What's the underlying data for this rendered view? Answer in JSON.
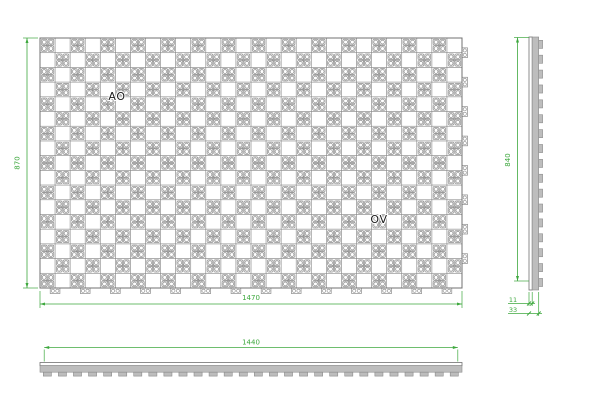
{
  "drawing": {
    "type": "cad-panel-drawing",
    "annotations": {
      "ao": "AO",
      "ov": "OV"
    },
    "dimensions": {
      "front_height": "870",
      "front_width": "1470",
      "side_height": "840",
      "plan_width": "1440",
      "thickness_inner": "11",
      "thickness_outer": "33"
    },
    "pattern": {
      "style": "checkerboard-perforated-modules",
      "columns": 28,
      "rows": 17,
      "right_tabs": 8,
      "bottom_tabs": 14,
      "side_teeth": 17,
      "bottom_teeth": 28
    },
    "colors": {
      "dimension_green": "#3EA83E",
      "line_gray": "#8C8C8C",
      "light_grid": "#C9C9C9",
      "outline": "#707070",
      "section_fill": "#BDBDBD",
      "label_text": "#1A1A1A"
    }
  }
}
